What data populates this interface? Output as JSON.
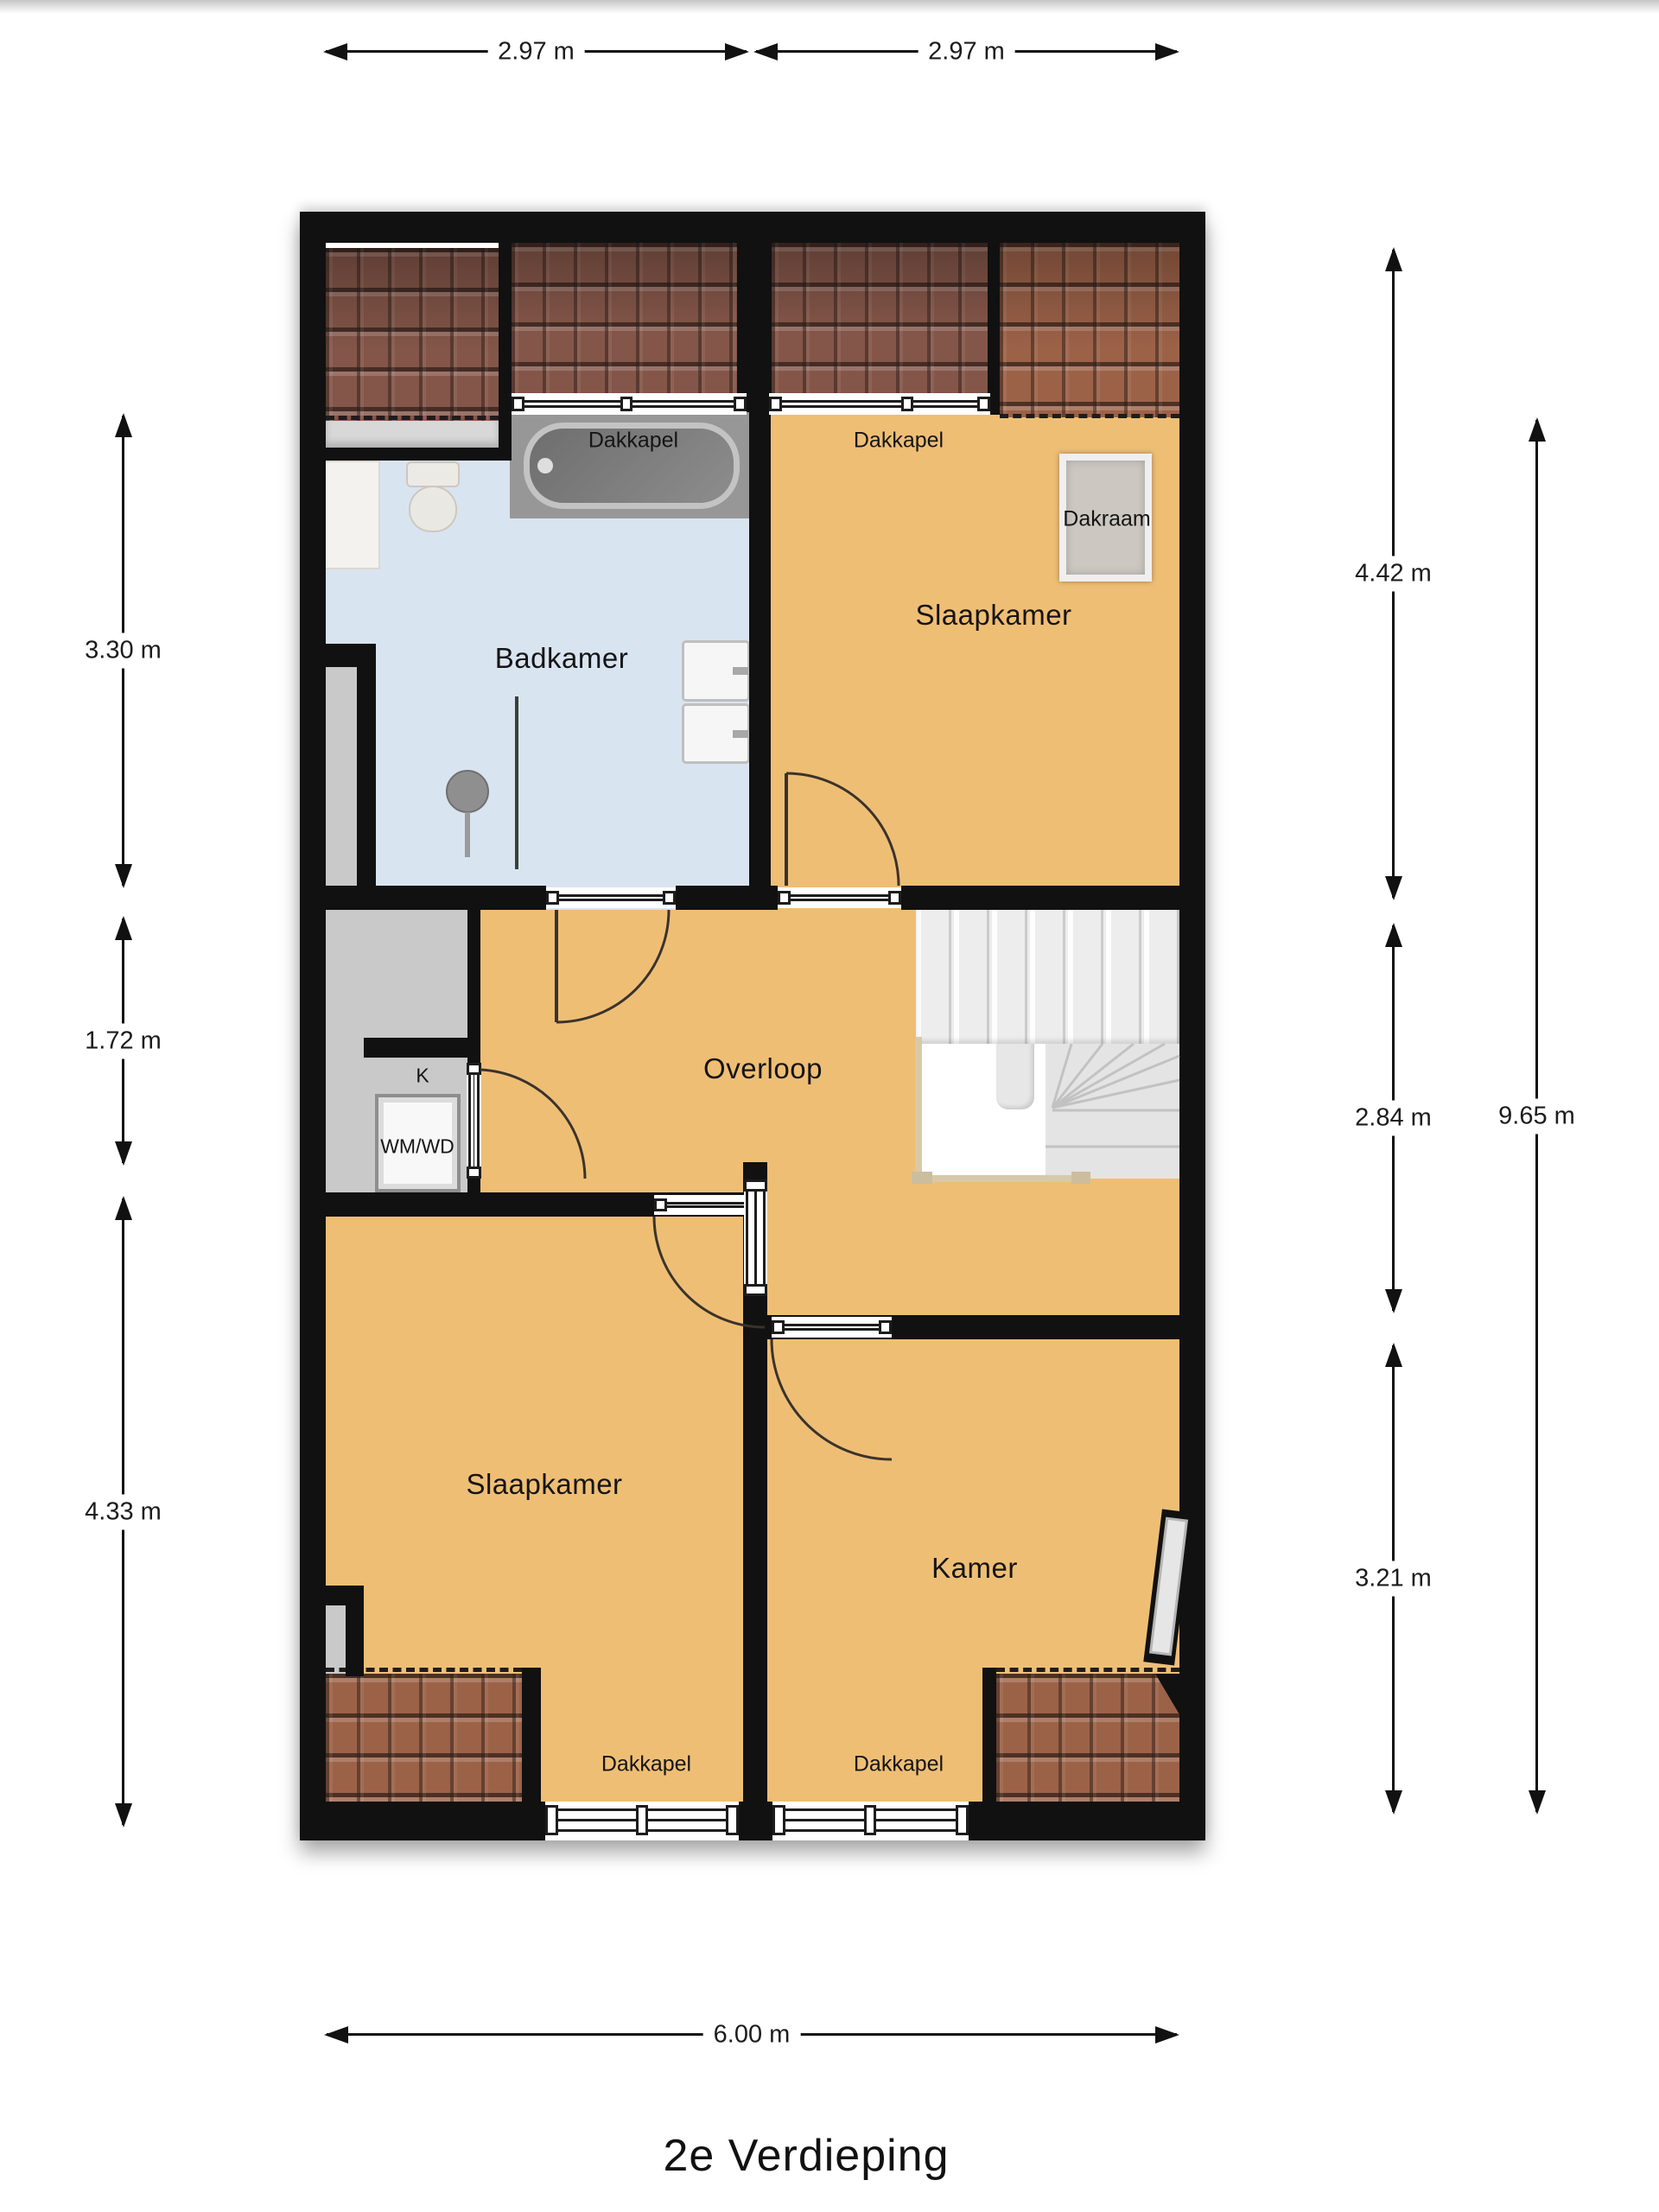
{
  "title": "2e Verdieping",
  "rooms": {
    "badkamer": "Badkamer",
    "slaapkamer_top": "Slaapkamer",
    "overloop": "Overloop",
    "slaapkamer_bottom": "Slaapkamer",
    "kamer": "Kamer",
    "closet_k": "K",
    "washer": "WM/WD"
  },
  "features": {
    "dakkapel_badkamer": "Dakkapel",
    "dakkapel_slaapkamer_top": "Dakkapel",
    "dakkapel_slaapkamer_bottom": "Dakkapel",
    "dakkapel_kamer": "Dakkapel",
    "dakraam": "Dakraam"
  },
  "dimensions": {
    "top": [
      "2.97 m",
      "2.97 m"
    ],
    "left": [
      "3.30 m",
      "1.72 m",
      "4.33 m"
    ],
    "right": [
      "4.42 m",
      "2.84 m",
      "3.21 m"
    ],
    "right_total": "9.65 m",
    "bottom": "6.00 m"
  },
  "colors": {
    "wall": "#111111",
    "floor_orange": "#efbe75",
    "floor_blue": "#d9e4f1",
    "roof_dark": "#845649",
    "roof_light": "#9c6248",
    "gray_zone": "#c9c9c9",
    "stairs": "#ededed",
    "railing": "#d8c9a8"
  }
}
